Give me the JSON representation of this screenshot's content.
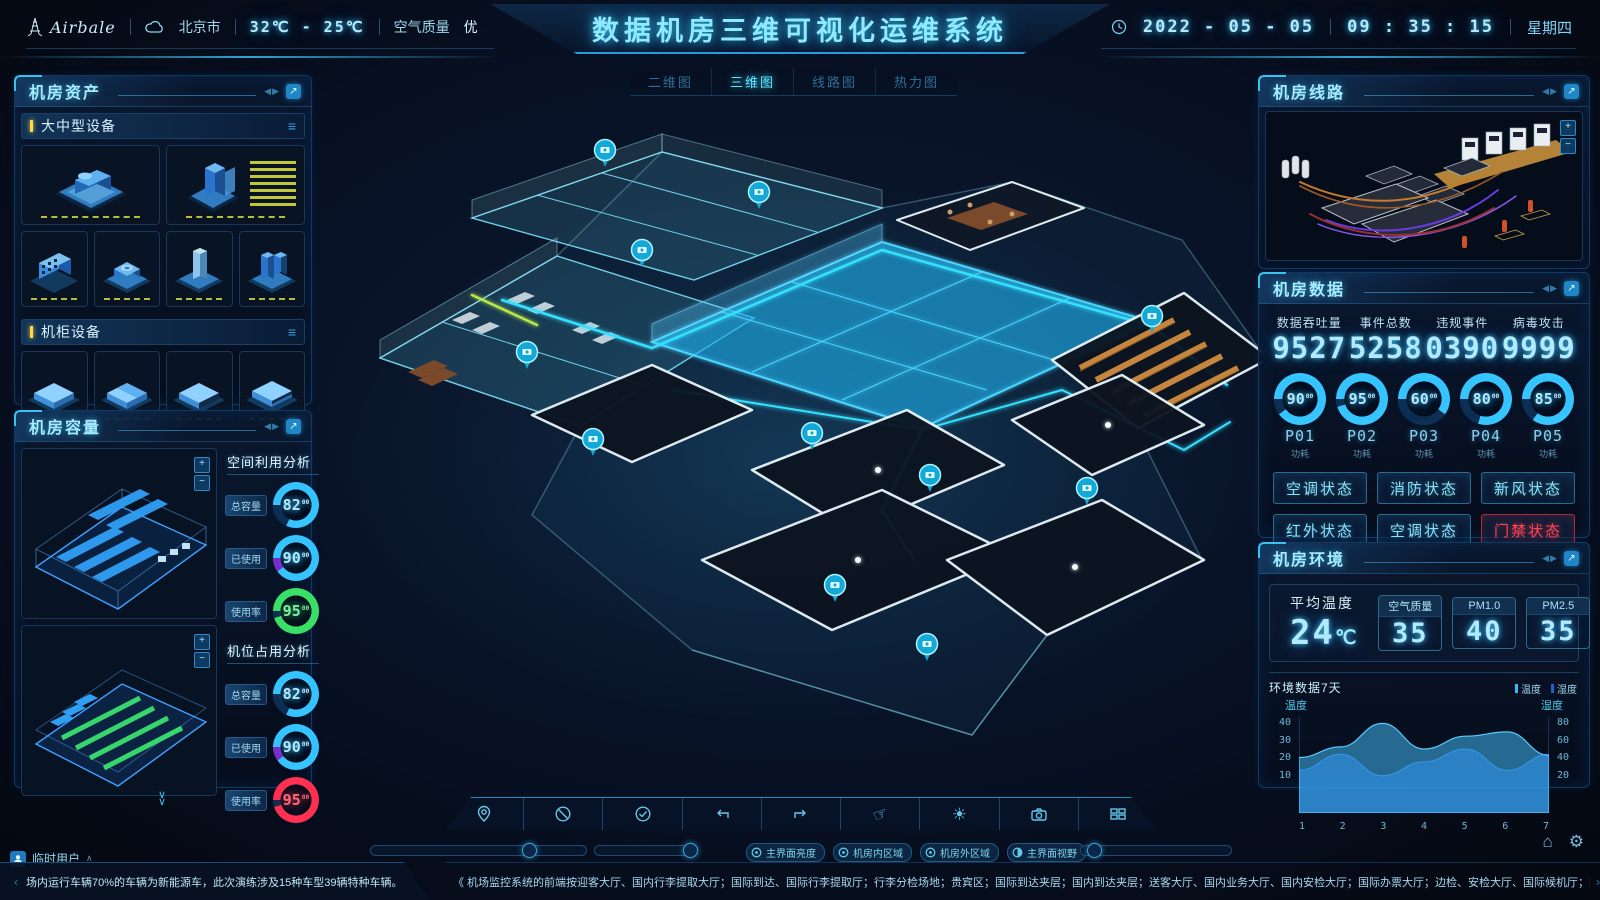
{
  "icons": {
    "collapse": "◀▶",
    "expand": "↗",
    "menu": "≡",
    "home": "⌂",
    "settings": "⚙",
    "caret_up": "∧",
    "prev": "‹",
    "next": "›",
    "plus": "+",
    "minus": "−",
    "brightness": "☀",
    "hand": "☞",
    "chevron_down": "∨"
  },
  "header": {
    "logo_text": "Airbale",
    "city": "北京市",
    "temp_range": "32℃ - 25℃",
    "air_quality_label": "空气质量",
    "air_quality_value": "优",
    "title": "数据机房三维可视化运维系统",
    "date": "2022 - 05 - 05",
    "time": "09 : 35 : 15",
    "weekday": "星期四"
  },
  "view_tabs": {
    "active": "三维图",
    "items": [
      {
        "label": "二维图"
      },
      {
        "label": "三维图"
      },
      {
        "label": "线路图"
      },
      {
        "label": "热力图"
      }
    ]
  },
  "assets_panel": {
    "title": "机房资产",
    "section1": "大中型设备",
    "section2": "机柜设备"
  },
  "capacity_panel": {
    "title": "机房容量",
    "group1": {
      "title": "空间利用分析",
      "gauges": [
        {
          "label": "总容量",
          "value": "82",
          "frac": "00",
          "pct": 82,
          "color": "#38c6ff",
          "rest": "#0e2e52"
        },
        {
          "label": "已使用",
          "value": "90",
          "frac": "00",
          "pct": 90,
          "color": "#38c6ff",
          "rest": "#7a2cc8"
        },
        {
          "label": "使用率",
          "value": "95",
          "frac": "00",
          "pct": 95,
          "color": "#3ae066",
          "rest": "#0e2e52"
        }
      ]
    },
    "group2": {
      "title": "机位占用分析",
      "gauges": [
        {
          "label": "总容量",
          "value": "82",
          "frac": "00",
          "pct": 82,
          "color": "#38c6ff",
          "rest": "#0e2e52"
        },
        {
          "label": "已使用",
          "value": "90",
          "frac": "00",
          "pct": 90,
          "color": "#38c6ff",
          "rest": "#7a2cc8"
        },
        {
          "label": "使用率",
          "value": "95",
          "frac": "00",
          "pct": 95,
          "color": "#ff3050",
          "rest": "#0e2e52"
        }
      ]
    }
  },
  "lines_panel": {
    "title": "机房线路"
  },
  "data_panel": {
    "title": "机房数据",
    "stats": [
      {
        "label": "数据吞吐量",
        "value": "9527"
      },
      {
        "label": "事件总数",
        "value": "5258"
      },
      {
        "label": "违规事件",
        "value": "0390"
      },
      {
        "label": "病毒攻击",
        "value": "9999"
      }
    ],
    "gauges": [
      {
        "value": "90",
        "frac": "00",
        "name": "P01",
        "sub": "功耗",
        "pct": 90,
        "color": "#38c6ff",
        "rest": "#0e2e52"
      },
      {
        "value": "95",
        "frac": "00",
        "name": "P02",
        "sub": "功耗",
        "pct": 95,
        "color": "#38c6ff",
        "rest": "#0e2e52"
      },
      {
        "value": "60",
        "frac": "00",
        "name": "P03",
        "sub": "功耗",
        "pct": 60,
        "color": "#38c6ff",
        "rest": "#0e2e52"
      },
      {
        "value": "80",
        "frac": "00",
        "name": "P04",
        "sub": "功耗",
        "pct": 80,
        "color": "#38c6ff",
        "rest": "#0e2e52"
      },
      {
        "value": "85",
        "frac": "00",
        "name": "P05",
        "sub": "功耗",
        "pct": 85,
        "color": "#38c6ff",
        "rest": "#0e2e52"
      }
    ],
    "buttons": [
      {
        "label": "空调状态",
        "alert": false
      },
      {
        "label": "消防状态",
        "alert": false
      },
      {
        "label": "新风状态",
        "alert": false
      },
      {
        "label": "红外状态",
        "alert": false
      },
      {
        "label": "空调状态",
        "alert": false
      },
      {
        "label": "门禁状态",
        "alert": true
      }
    ]
  },
  "env_panel": {
    "title": "机房环境",
    "avg_label": "平均温度",
    "avg_value": "24",
    "avg_unit": "℃",
    "metrics": [
      {
        "label": "空气质量",
        "value": "35"
      },
      {
        "label": "PM1.0",
        "value": "40"
      },
      {
        "label": "PM2.5",
        "value": "35"
      }
    ]
  },
  "chart_data": {
    "type": "area",
    "title": "环境数据7天",
    "x": [
      1,
      2,
      3,
      4,
      5,
      6,
      7
    ],
    "series": [
      {
        "name": "温度",
        "axis": "left",
        "color": "#3fb6f0",
        "values": [
          26,
          31,
          42,
          30,
          36,
          38,
          27
        ]
      },
      {
        "name": "湿度",
        "axis": "right",
        "color": "#1f5fd0",
        "values": [
          40,
          55,
          35,
          48,
          60,
          40,
          55
        ]
      }
    ],
    "left_axis": {
      "label": "温度",
      "ticks": [
        40,
        30,
        20,
        10
      ],
      "range": [
        0,
        45
      ]
    },
    "right_axis": {
      "label": "湿度",
      "ticks": [
        80,
        60,
        40,
        20
      ],
      "range": [
        0,
        90
      ]
    },
    "grid": false,
    "legend_position": "top-right"
  },
  "controls": {
    "chips": [
      {
        "label": "主界面亮度"
      },
      {
        "label": "机房内区域"
      },
      {
        "label": "机房外区域"
      },
      {
        "label": "主界面视野"
      }
    ]
  },
  "footer": {
    "user": "临时用户",
    "ticker_left": "场内运行车辆70%的车辆为新能源车，此次演练涉及15种车型39辆特种车辆。",
    "ticker_right": "《 机场监控系统的前端按迎客大厅、国内行李提取大厅；国际到达、国际行李提取厅；行李分检场地；贵宾区；国际到达夹层；国内到达夹层；送客大厅、国内业务大厅、国内安检大厅；国际办票大厅；边检、安检大厅、国际候机厅；国内候机厅、远机位候机厅；地下停车场；陆侧航站楼进口；机坪；"
  }
}
